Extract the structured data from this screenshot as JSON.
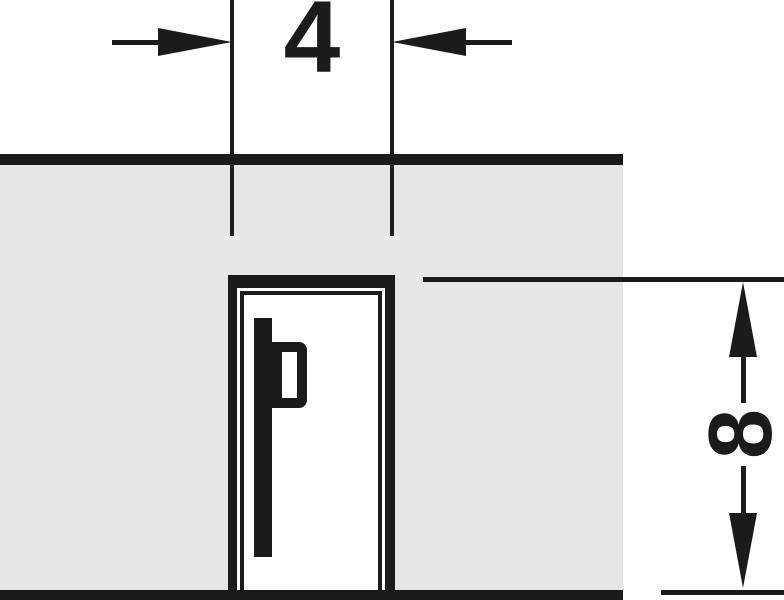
{
  "diagram": {
    "type": "technical-drawing",
    "description": "Cross-section of a panel edge with a milled groove holding a clip profile; groove width and depth dimensioned in mm",
    "dimensions": {
      "groove_width": {
        "label": "4"
      },
      "groove_depth": {
        "label": "8"
      }
    },
    "colors": {
      "line": "#1b1b1d",
      "panel_fill": "#e6e6e8",
      "background": "#ffffff"
    }
  }
}
